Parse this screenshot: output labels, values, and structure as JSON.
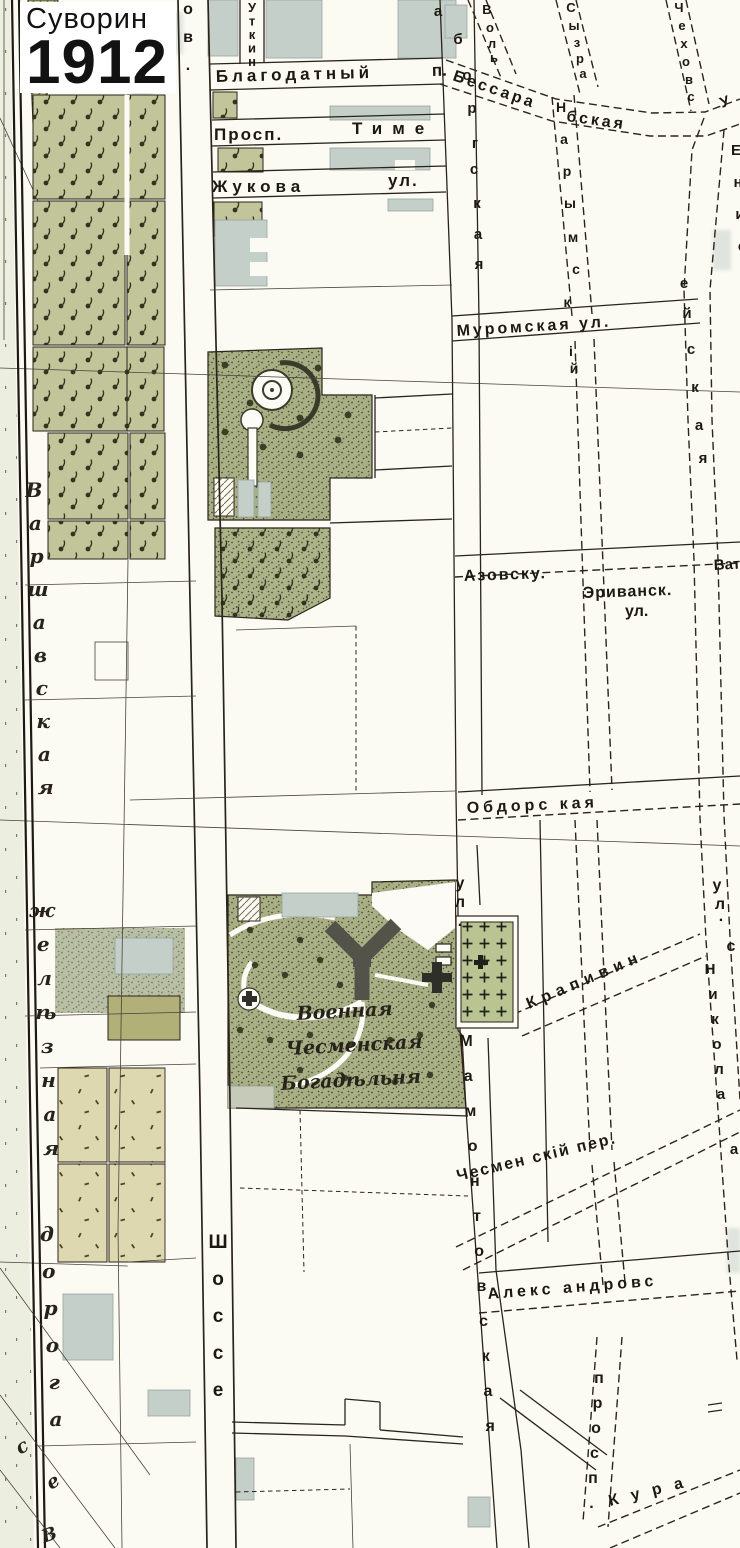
{
  "map": {
    "publisher": "Суворин",
    "year": "1912",
    "colors": {
      "paper": "#fbfaf3",
      "ink": "#2b241a",
      "building_gray": "#c4cfc9",
      "orchard_green": "#c2c49a",
      "park_green": "#a9af85",
      "cemetery_green": "#b9c492",
      "field_beige": "#ddd8b0",
      "margin_pale": "#eceee0",
      "almshouse_dark": "#53534a"
    },
    "labels": [
      {
        "id": "blagodatny",
        "text": "Благодатный",
        "x": 216,
        "y": 82,
        "rotate": -1.5,
        "size": 17,
        "ls": 4
      },
      {
        "id": "blagodatny-p",
        "text": "п.",
        "x": 432,
        "y": 76,
        "rotate": -1.5,
        "size": 17
      },
      {
        "id": "prosp",
        "text": "Просп.",
        "x": 214,
        "y": 140,
        "size": 17,
        "ls": 2
      },
      {
        "id": "time",
        "text": "Тиме",
        "x": 352,
        "y": 134,
        "size": 17,
        "ls": 10
      },
      {
        "id": "zhukova",
        "text": "Жукова",
        "x": 212,
        "y": 192,
        "size": 17,
        "ls": 5
      },
      {
        "id": "zhukova-ul",
        "text": "ул.",
        "x": 388,
        "y": 186,
        "size": 17,
        "ls": 2
      },
      {
        "id": "muromskaya",
        "text": "Муромская ул.",
        "x": 457,
        "y": 336,
        "rotate": -3.5,
        "size": 16,
        "ls": 3
      },
      {
        "id": "bessarabskaya-1",
        "text": "Бессара",
        "x": 452,
        "y": 80,
        "rotate": 19,
        "size": 16,
        "ls": 3
      },
      {
        "id": "bessarabskaya-2",
        "text": "бская",
        "x": 566,
        "y": 121,
        "rotate": 8,
        "size": 16,
        "ls": 3
      },
      {
        "id": "u-street",
        "text": "У",
        "x": 722,
        "y": 108,
        "rotate": -20,
        "size": 15
      },
      {
        "id": "azovskaya",
        "text": "Азовску.",
        "x": 464,
        "y": 581,
        "rotate": -2,
        "size": 16,
        "ls": 2
      },
      {
        "id": "erivansk",
        "text": "Эриванск.",
        "x": 583,
        "y": 598,
        "rotate": -2,
        "size": 16,
        "ls": 1
      },
      {
        "id": "erivansk-ul",
        "text": "ул.",
        "x": 625,
        "y": 616,
        "size": 16
      },
      {
        "id": "vat",
        "text": "Ват",
        "x": 714,
        "y": 570,
        "rotate": -3,
        "size": 15
      },
      {
        "id": "obdorskaya",
        "text": "Обдорс кая",
        "x": 467,
        "y": 813,
        "rotate": -2.5,
        "size": 16,
        "ls": 4
      },
      {
        "id": "krapivin",
        "text": "Крапивин",
        "x": 529,
        "y": 1009,
        "rotate": -23,
        "size": 16,
        "ls": 6
      },
      {
        "id": "chesmensky-per",
        "text": "Чесмен скій пер.",
        "x": 458,
        "y": 1181,
        "rotate": -13.5,
        "size": 16,
        "ls": 2
      },
      {
        "id": "aleksandrovskaya",
        "text": "Алекс андровс",
        "x": 488,
        "y": 1299,
        "rotate": -4.5,
        "size": 16,
        "ls": 4
      },
      {
        "id": "kura",
        "text": "Кура",
        "x": 610,
        "y": 1506,
        "rotate": -14,
        "size": 16,
        "ls": 13
      },
      {
        "id": "voennaya",
        "text": "Военная",
        "x": 297,
        "y": 1020,
        "rotate": -3,
        "size": 19,
        "cls": "ital"
      },
      {
        "id": "chesmenskaya",
        "text": "Чесменская",
        "x": 286,
        "y": 1055,
        "rotate": -3,
        "size": 19,
        "cls": "ital"
      },
      {
        "id": "bogadelnya",
        "text": "Богадѣльня",
        "x": 281,
        "y": 1090,
        "rotate": -3,
        "size": 19,
        "cls": "ital"
      },
      {
        "id": "ov",
        "vertical": true,
        "text": "ов.",
        "x": 188,
        "y": 14,
        "step": 28,
        "size": 16
      },
      {
        "id": "utkin",
        "vertical": true,
        "text": "Уткин",
        "x": 252,
        "y": 12,
        "step": 13.5,
        "size": 13
      },
      {
        "id": "aborgskaya",
        "size": 15,
        "letters": [
          [
            "а",
            438,
            16
          ],
          [
            "б",
            458,
            44
          ],
          [
            "о",
            467,
            80
          ],
          [
            "р",
            472,
            113
          ],
          [
            "г",
            475,
            148
          ],
          [
            "с",
            474,
            174
          ],
          [
            "к",
            477,
            208
          ],
          [
            "а",
            478,
            239
          ],
          [
            "я",
            479,
            269
          ]
        ]
      },
      {
        "id": "volskaya",
        "size": 13,
        "letters": [
          [
            "В",
            487,
            14
          ],
          [
            "о",
            490,
            32
          ],
          [
            "л",
            492,
            48
          ],
          [
            "ь",
            494,
            62
          ]
        ]
      },
      {
        "id": "syzranskaya",
        "size": 13,
        "letters": [
          [
            "С",
            571,
            12
          ],
          [
            "ы",
            574,
            30
          ],
          [
            "з",
            577,
            47
          ],
          [
            "р",
            580,
            63
          ],
          [
            "а",
            583,
            78
          ]
        ]
      },
      {
        "id": "chekhovskaya",
        "size": 13,
        "letters": [
          [
            "Ч",
            679,
            12
          ],
          [
            "е",
            682,
            30
          ],
          [
            "х",
            684,
            48
          ],
          [
            "о",
            686,
            66
          ],
          [
            "в",
            689,
            84
          ],
          [
            "с",
            691,
            101
          ]
        ]
      },
      {
        "id": "narymsky",
        "size": 14,
        "letters": [
          [
            "Н",
            561,
            112
          ],
          [
            "а",
            564,
            144
          ],
          [
            "р",
            567,
            176
          ],
          [
            "ы",
            570,
            208
          ],
          [
            "м",
            573,
            242
          ],
          [
            "с",
            576,
            274
          ],
          [
            "к",
            567,
            307
          ],
          [
            "і",
            571,
            356
          ],
          [
            "й",
            574,
            373
          ]
        ]
      },
      {
        "id": "enis",
        "size": 15,
        "letters": [
          [
            "Е",
            736,
            155
          ],
          [
            "н",
            738,
            187
          ],
          [
            "и",
            740,
            219
          ],
          [
            "с",
            742,
            251
          ]
        ]
      },
      {
        "id": "eiskaya",
        "size": 15,
        "letters": [
          [
            "е",
            684,
            288
          ],
          [
            "й",
            687,
            318
          ],
          [
            "с",
            691,
            354
          ],
          [
            "к",
            695,
            392
          ],
          [
            "а",
            699,
            430
          ],
          [
            "я",
            703,
            463
          ]
        ]
      },
      {
        "id": "ul-s",
        "size": 16,
        "letters": [
          [
            "у",
            717,
            890
          ],
          [
            "л",
            720,
            909
          ],
          [
            ".",
            721,
            921
          ],
          [
            "с",
            731,
            951
          ]
        ]
      },
      {
        "id": "nikola",
        "size": 15,
        "letters": [
          [
            "Н",
            710,
            974
          ],
          [
            "и",
            713,
            999
          ],
          [
            "к",
            715,
            1024
          ],
          [
            "о",
            717,
            1049
          ],
          [
            "л",
            719,
            1074
          ],
          [
            "а",
            721,
            1099
          ],
          [
            "а",
            734,
            1154
          ]
        ]
      },
      {
        "id": "mamontovskaya-ul",
        "vertical": true,
        "text": "ул.",
        "x": 460,
        "y": 888,
        "step": 19,
        "size": 16
      },
      {
        "id": "mamontovskaya",
        "vertical": true,
        "text": "Мамонтовская",
        "x": 466,
        "y": 1046,
        "step": 35,
        "dx": 2.2,
        "size": 16
      },
      {
        "id": "shosse",
        "vertical": true,
        "text": "Шоссе",
        "x": 218,
        "y": 1248,
        "step": 37,
        "size": 19
      },
      {
        "id": "prospekt",
        "vertical": true,
        "text": "просп.",
        "x": 599,
        "y": 1383,
        "step": 25,
        "dx": -1.5,
        "size": 16
      },
      {
        "id": "varshavskaya",
        "vertical": true,
        "text": "Варшавская",
        "x": 34,
        "y": 497,
        "step": 33,
        "dx": 1.3,
        "size": 20,
        "cls": "ital"
      },
      {
        "id": "zheleznaya",
        "vertical": true,
        "text": "желѣзная",
        "x": 42,
        "y": 917,
        "step": 34,
        "dx": 1.3,
        "size": 20,
        "cls": "ital"
      },
      {
        "id": "doroga",
        "vertical": true,
        "text": "дорога",
        "x": 47,
        "y": 1241,
        "step": 37,
        "dx": 1.8,
        "size": 20,
        "cls": "ital"
      },
      {
        "id": "v-continuation",
        "text": "В",
        "x": 44,
        "y": 1543,
        "rotate": -20,
        "size": 18,
        "cls": "ital"
      },
      {
        "id": "se-diagonal",
        "size": 19,
        "cls": "ital",
        "rotate": -30,
        "letters": [
          [
            "с",
            25,
            1452
          ],
          [
            "е",
            56,
            1487
          ]
        ]
      }
    ]
  }
}
